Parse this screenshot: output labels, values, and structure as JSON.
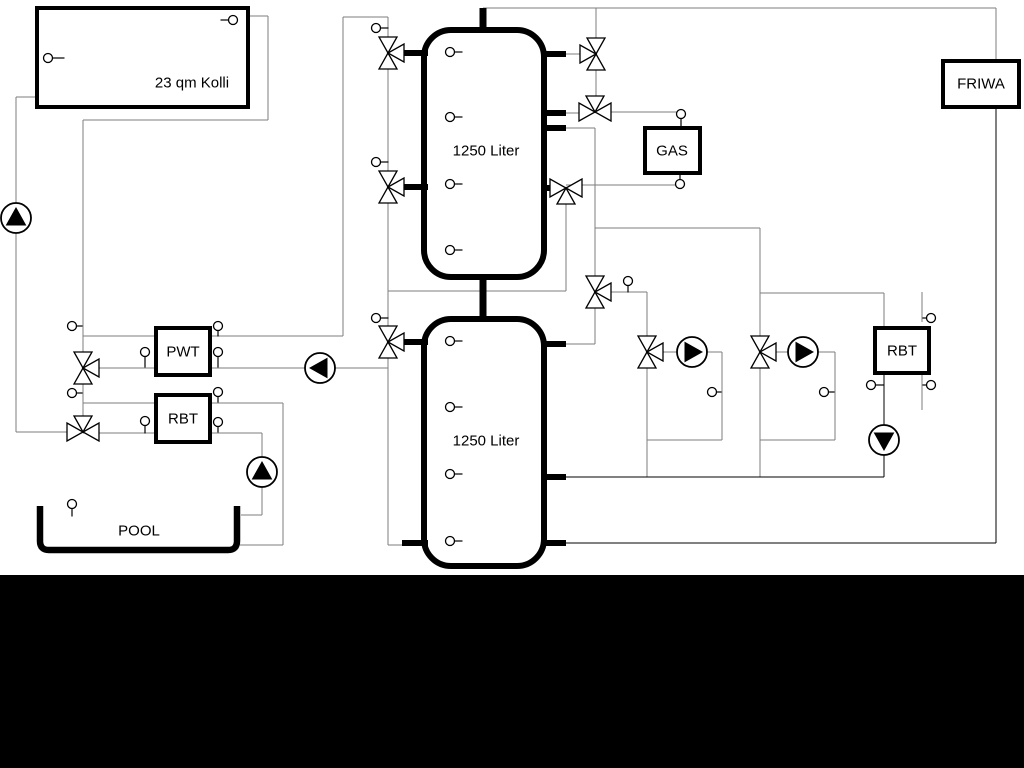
{
  "colors": {
    "bg": "#ffffff",
    "pipe": "#7d7d7d",
    "ink": "#000000",
    "band": "#000000"
  },
  "labels": {
    "collector": "23 qm Kolli",
    "tank_top": "1250 Liter",
    "tank_bottom": "1250 Liter",
    "gas": "GAS",
    "friwa": "FRIWA",
    "pwt": "PWT",
    "rbt_left": "RBT",
    "rbt_right": "RBT",
    "pool": "POOL"
  },
  "diagram": {
    "band": {
      "x": 0,
      "y": 575,
      "w": 1024,
      "h": 193
    },
    "pipes": {
      "gray": [
        [
          248,
          16,
          268,
          16
        ],
        [
          268,
          16,
          268,
          120
        ],
        [
          268,
          120,
          83,
          120
        ],
        [
          83,
          120,
          83,
          432
        ],
        [
          16,
          97,
          37,
          97
        ],
        [
          16,
          97,
          16,
          432
        ],
        [
          16,
          432,
          83,
          432
        ],
        [
          83,
          336,
          156,
          336
        ],
        [
          83,
          368,
          156,
          368
        ],
        [
          83,
          403,
          156,
          403
        ],
        [
          83,
          433,
          156,
          433
        ],
        [
          210,
          336,
          343,
          336
        ],
        [
          343,
          336,
          343,
          17
        ],
        [
          343,
          17,
          388,
          17
        ],
        [
          388,
          17,
          388,
          545
        ],
        [
          210,
          368,
          388,
          368
        ],
        [
          388,
          545,
          406,
          545
        ],
        [
          210,
          403,
          283,
          403
        ],
        [
          283,
          403,
          283,
          545
        ],
        [
          283,
          545,
          240,
          545
        ],
        [
          210,
          433,
          262,
          433
        ],
        [
          262,
          433,
          262,
          515
        ],
        [
          262,
          515,
          241,
          515
        ],
        [
          388,
          291,
          566,
          291
        ],
        [
          566,
          291,
          566,
          188
        ],
        [
          554,
          188,
          566,
          188
        ],
        [
          566,
          185,
          676,
          185
        ],
        [
          565,
          54,
          581,
          54
        ],
        [
          596,
          8,
          596,
          112
        ],
        [
          483,
          8,
          996,
          8
        ],
        [
          996,
          8,
          996,
          61
        ],
        [
          565,
          113,
          581,
          113
        ],
        [
          595,
          112,
          677,
          112
        ],
        [
          565,
          128,
          595,
          128
        ],
        [
          595,
          128,
          595,
          292
        ],
        [
          595,
          228,
          760,
          228
        ],
        [
          760,
          228,
          760,
          342
        ],
        [
          760,
          293,
          884,
          293
        ],
        [
          884,
          293,
          884,
          328
        ],
        [
          595,
          292,
          647,
          292
        ],
        [
          647,
          292,
          647,
          352
        ],
        [
          595,
          292,
          595,
          344
        ],
        [
          595,
          344,
          565,
          344
        ],
        [
          647,
          352,
          678,
          352
        ],
        [
          706,
          352,
          722,
          352
        ],
        [
          722,
          352,
          722,
          440
        ],
        [
          722,
          440,
          647,
          440
        ],
        [
          647,
          352,
          647,
          477
        ],
        [
          760,
          352,
          791,
          352
        ],
        [
          817,
          352,
          835,
          352
        ],
        [
          835,
          352,
          835,
          440
        ],
        [
          835,
          440,
          760,
          440
        ],
        [
          760,
          352,
          760,
          477
        ],
        [
          922,
          292,
          922,
          322
        ],
        [
          922,
          373,
          922,
          410
        ]
      ],
      "black": [
        [
          565,
          477,
          884,
          477
        ],
        [
          884,
          373,
          884,
          477
        ],
        [
          565,
          543,
          996,
          543
        ],
        [
          996,
          107,
          996,
          543
        ]
      ],
      "stub6": [
        [
          398,
          53,
          428,
          53
        ],
        [
          398,
          187,
          428,
          187
        ],
        [
          398,
          342,
          428,
          342
        ],
        [
          402,
          543,
          428,
          543
        ],
        [
          541,
          54,
          566,
          54
        ],
        [
          541,
          113,
          566,
          113
        ],
        [
          541,
          128,
          566,
          128
        ],
        [
          541,
          188,
          555,
          188
        ],
        [
          541,
          344,
          566,
          344
        ],
        [
          541,
          477,
          566,
          477
        ],
        [
          541,
          543,
          566,
          543
        ]
      ],
      "stub7": [
        [
          483,
          8,
          483,
          33
        ],
        [
          483,
          275,
          483,
          322
        ]
      ]
    },
    "boxes": [
      {
        "id": "collector-box",
        "x": 37,
        "y": 8,
        "w": 211,
        "h": 99,
        "bw": 4,
        "bind": "labels.collector",
        "lx": 192,
        "ly": 83,
        "fs": 15
      },
      {
        "id": "pwt-box",
        "x": 156,
        "y": 328,
        "w": 54,
        "h": 47,
        "bw": 4,
        "bind": "labels.pwt",
        "lx": 183,
        "ly": 352,
        "fs": 15
      },
      {
        "id": "rbt-left-box",
        "x": 156,
        "y": 395,
        "w": 54,
        "h": 47,
        "bw": 4,
        "bind": "labels.rbt_left",
        "lx": 183,
        "ly": 419,
        "fs": 15
      },
      {
        "id": "gas-box",
        "x": 645,
        "y": 128,
        "w": 55,
        "h": 45,
        "bw": 4,
        "bind": "labels.gas",
        "lx": 672,
        "ly": 151,
        "fs": 15
      },
      {
        "id": "friwa-box",
        "x": 943,
        "y": 61,
        "w": 76,
        "h": 46,
        "bw": 4,
        "bind": "labels.friwa",
        "lx": 981,
        "ly": 84,
        "fs": 15
      },
      {
        "id": "rbt-right-box",
        "x": 875,
        "y": 328,
        "w": 54,
        "h": 45,
        "bw": 4,
        "bind": "labels.rbt_right",
        "lx": 902,
        "ly": 351,
        "fs": 15
      }
    ],
    "tanks": [
      {
        "id": "buffer-tank-top",
        "x": 424,
        "y": 30,
        "w": 120,
        "h": 247,
        "r": 27,
        "bw": 6,
        "bind": "labels.tank_top",
        "lx": 486,
        "ly": 151,
        "fs": 15
      },
      {
        "id": "buffer-tank-bottom",
        "x": 424,
        "y": 319,
        "w": 120,
        "h": 247,
        "r": 27,
        "bw": 6,
        "bind": "labels.tank_bottom",
        "lx": 486,
        "ly": 441,
        "fs": 15
      }
    ],
    "pool": {
      "x1": 40,
      "yt": 506,
      "x2": 237,
      "yb": 550,
      "r": 9,
      "bw": 6.5,
      "bind": "labels.pool",
      "lx": 139,
      "ly": 531,
      "fs": 15
    },
    "valves": [
      {
        "x": 388,
        "y": 53,
        "o": "TBR"
      },
      {
        "x": 388,
        "y": 187,
        "o": "TBR"
      },
      {
        "x": 388,
        "y": 342,
        "o": "TBR"
      },
      {
        "x": 83,
        "y": 368,
        "o": "TBR"
      },
      {
        "x": 83,
        "y": 432,
        "o": "LRT"
      },
      {
        "x": 596,
        "y": 54,
        "o": "TBL"
      },
      {
        "x": 595,
        "y": 112,
        "o": "LRT"
      },
      {
        "x": 566,
        "y": 188,
        "o": "LRB"
      },
      {
        "x": 595,
        "y": 292,
        "o": "TBR"
      },
      {
        "x": 647,
        "y": 352,
        "o": "TBR"
      },
      {
        "x": 760,
        "y": 352,
        "o": "TBR"
      }
    ],
    "pumps": [
      {
        "x": 16,
        "y": 218,
        "d": "up"
      },
      {
        "x": 320,
        "y": 368,
        "d": "left"
      },
      {
        "x": 262,
        "y": 472,
        "d": "up"
      },
      {
        "x": 692,
        "y": 352,
        "d": "right"
      },
      {
        "x": 803,
        "y": 352,
        "d": "right"
      },
      {
        "x": 884,
        "y": 440,
        "d": "down"
      }
    ],
    "sensors": [
      {
        "x": 233,
        "y": 20,
        "d": "left",
        "l": 8
      },
      {
        "x": 48,
        "y": 58,
        "d": "right",
        "l": 12
      },
      {
        "x": 376,
        "y": 28,
        "d": "right",
        "l": 8
      },
      {
        "x": 376,
        "y": 162,
        "d": "right",
        "l": 8
      },
      {
        "x": 376,
        "y": 318,
        "d": "right",
        "l": 8
      },
      {
        "x": 450,
        "y": 52,
        "d": "right",
        "l": 8
      },
      {
        "x": 450,
        "y": 117,
        "d": "right",
        "l": 8
      },
      {
        "x": 450,
        "y": 184,
        "d": "right",
        "l": 8
      },
      {
        "x": 450,
        "y": 250,
        "d": "right",
        "l": 8
      },
      {
        "x": 450,
        "y": 341,
        "d": "right",
        "l": 8
      },
      {
        "x": 450,
        "y": 407,
        "d": "right",
        "l": 8
      },
      {
        "x": 450,
        "y": 474,
        "d": "right",
        "l": 8
      },
      {
        "x": 450,
        "y": 541,
        "d": "right",
        "l": 8
      },
      {
        "x": 72,
        "y": 326,
        "d": "right",
        "l": 6
      },
      {
        "x": 72,
        "y": 393,
        "d": "right",
        "l": 6
      },
      {
        "x": 145,
        "y": 352,
        "d": "down",
        "l": 11
      },
      {
        "x": 145,
        "y": 421,
        "d": "down",
        "l": 8
      },
      {
        "x": 218,
        "y": 326,
        "d": "down",
        "l": 6
      },
      {
        "x": 218,
        "y": 352,
        "d": "down",
        "l": 11
      },
      {
        "x": 218,
        "y": 392,
        "d": "down",
        "l": 6
      },
      {
        "x": 218,
        "y": 422,
        "d": "down",
        "l": 6
      },
      {
        "x": 681,
        "y": 114,
        "d": "down",
        "l": 10
      },
      {
        "x": 680,
        "y": 184,
        "d": "up",
        "l": 7
      },
      {
        "x": 628,
        "y": 281,
        "d": "down",
        "l": 7
      },
      {
        "x": 712,
        "y": 392,
        "d": "right",
        "l": 5
      },
      {
        "x": 824,
        "y": 392,
        "d": "right",
        "l": 6
      },
      {
        "x": 931,
        "y": 318,
        "d": "left",
        "l": 4
      },
      {
        "x": 931,
        "y": 385,
        "d": "left",
        "l": 4
      },
      {
        "x": 871,
        "y": 385,
        "d": "right",
        "l": 8
      },
      {
        "x": 72,
        "y": 504,
        "d": "down",
        "l": 8
      }
    ]
  }
}
